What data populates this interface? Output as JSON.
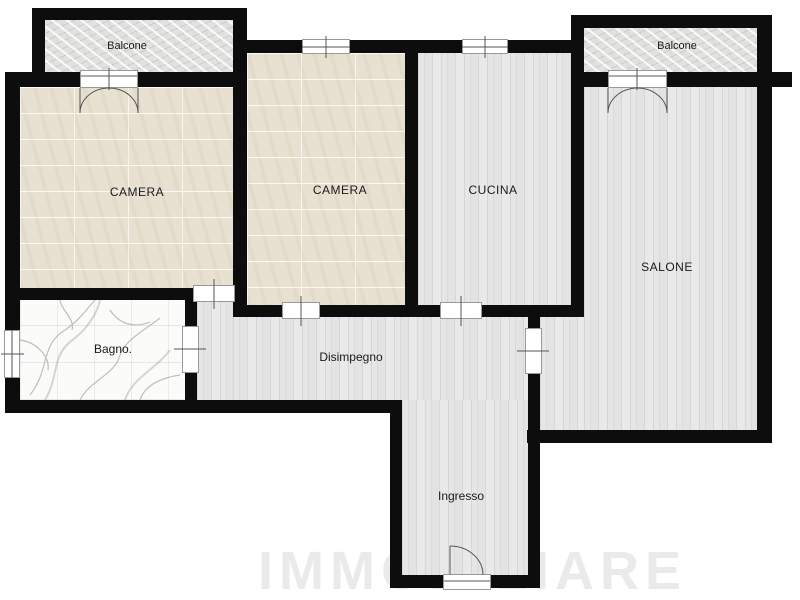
{
  "plan_type": "apartment-floor-plan",
  "colors": {
    "wall": "#0d0d0d",
    "background": "#ffffff",
    "floor_tile_beige": "#e8e1d1",
    "floor_wood_gray": "#e0e0e0",
    "floor_marble_white": "#fbfbfa",
    "floor_stone_gray": "#e1e1df",
    "label_text": "#1a1a1a"
  },
  "watermark_text": "IMMOBILIARE",
  "rooms": {
    "balcone_left": {
      "label": "Balcone",
      "floor": "stone"
    },
    "balcone_right": {
      "label": "Balcone",
      "floor": "stone"
    },
    "camera_left": {
      "label": "CAMERA",
      "floor": "tile-beige"
    },
    "camera_center": {
      "label": "CAMERA",
      "floor": "tile-beige"
    },
    "cucina": {
      "label": "CUCINA",
      "floor": "wood-gray"
    },
    "salone": {
      "label": "SALONE",
      "floor": "wood-gray"
    },
    "bagno": {
      "label": "Bagno.",
      "floor": "marble-white"
    },
    "disimpegno": {
      "label": "Disimpegno",
      "floor": "wood-gray"
    },
    "ingresso": {
      "label": "Ingresso",
      "floor": "wood-gray"
    }
  }
}
